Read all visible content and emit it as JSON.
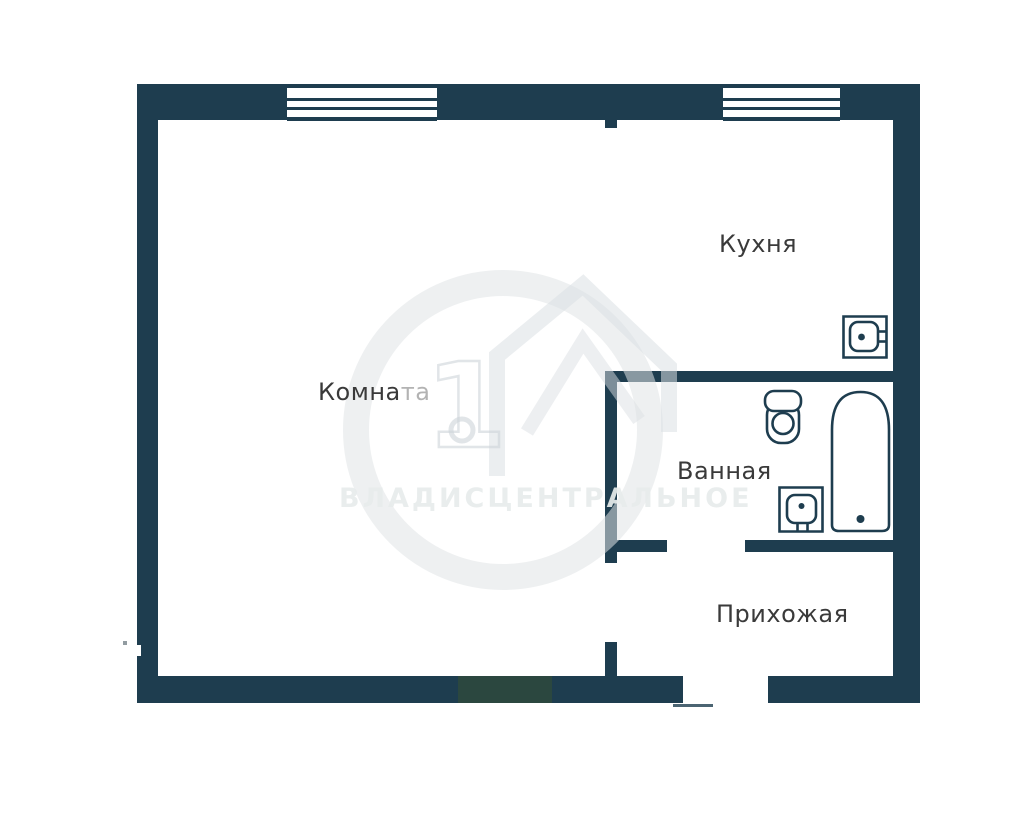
{
  "floor_plan": {
    "type": "apartment-floor-plan",
    "rooms": [
      {
        "name": "living-room",
        "label": "Комната",
        "label_main": "Комна",
        "label_faded": "та"
      },
      {
        "name": "kitchen",
        "label": "Кухня"
      },
      {
        "name": "bathroom",
        "label": "Ванная"
      },
      {
        "name": "hallway",
        "label": "Прихожая"
      }
    ],
    "fixtures": [
      {
        "name": "kitchen-sink"
      },
      {
        "name": "toilet"
      },
      {
        "name": "bathtub"
      },
      {
        "name": "washbasin"
      }
    ],
    "watermark": {
      "brand_text": "ВЛАДИСЦЕНТРАЛЬНОЕ",
      "logo_digit": "1"
    },
    "colors": {
      "wall": "#1e3d4f",
      "wall_green_tint": "#2b473f",
      "label": "#3a3a3a",
      "label_faded": "#b3b3b3",
      "watermark_text": "#e7ebec",
      "background": "#ffffff"
    }
  }
}
